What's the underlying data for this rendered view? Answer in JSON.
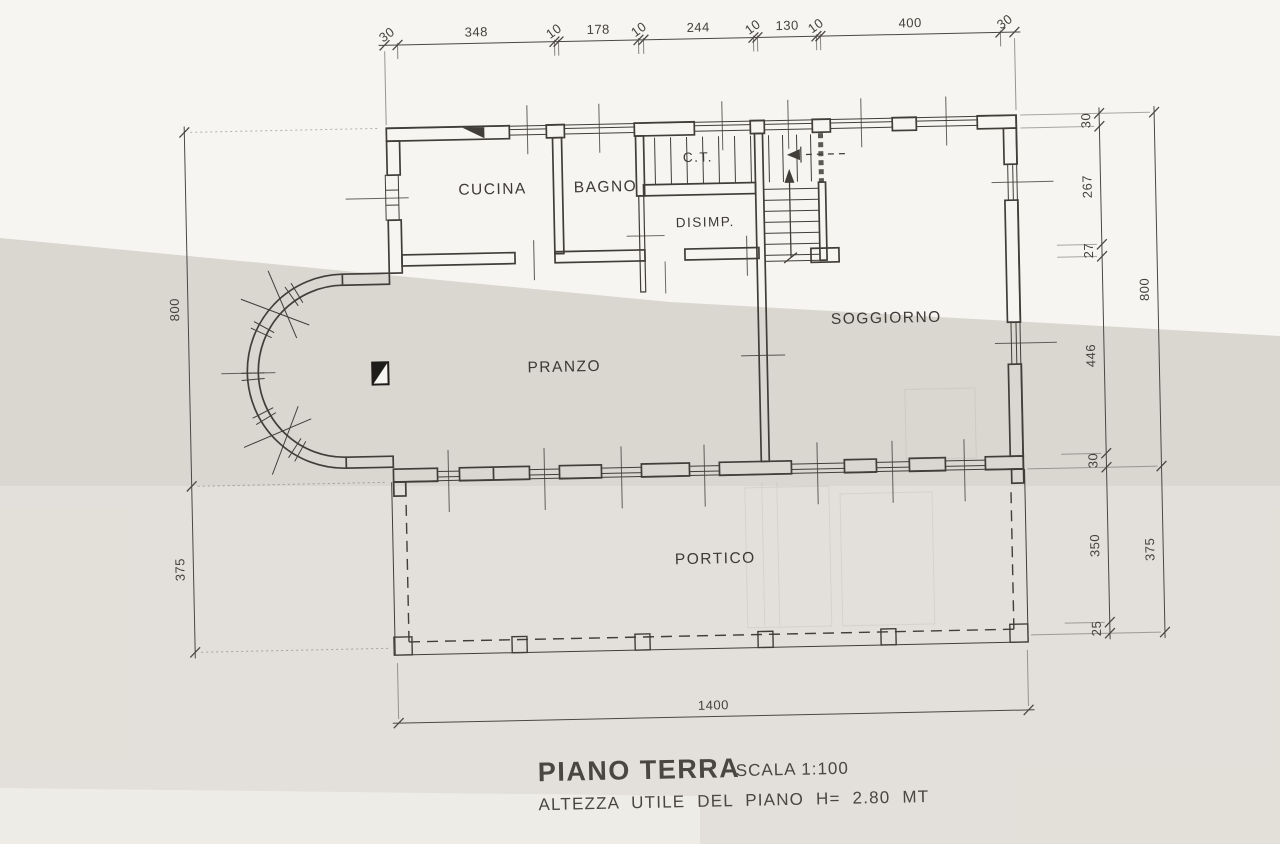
{
  "document": {
    "title": "PIANO TERRA",
    "scale_label": "SCALA 1:100",
    "height_note": "ALTEZZA UTILE DEL PIANO H= 2.80 MT"
  },
  "rooms": {
    "cucina": "CUCINA",
    "bagno": "BAGNO",
    "ct": "C.T.",
    "disimp": "DISIMP.",
    "soggiorno": "SOGGIORNO",
    "pranzo": "PRANZO",
    "portico": "PORTICO"
  },
  "dimensions": {
    "top": [
      "30",
      "348",
      "10",
      "178",
      "10",
      "244",
      "10",
      "130",
      "10",
      "400",
      "30"
    ],
    "right_inner": [
      "30",
      "267",
      "27",
      "446",
      "30",
      "350",
      "25"
    ],
    "right_outer": [
      "800",
      "375"
    ],
    "left": [
      "800",
      "375"
    ],
    "bottom": [
      "1400"
    ]
  },
  "colors": {
    "ink": "#413e3a",
    "paper": "#f7f5f1",
    "shade_band": "#cdc7bf"
  }
}
